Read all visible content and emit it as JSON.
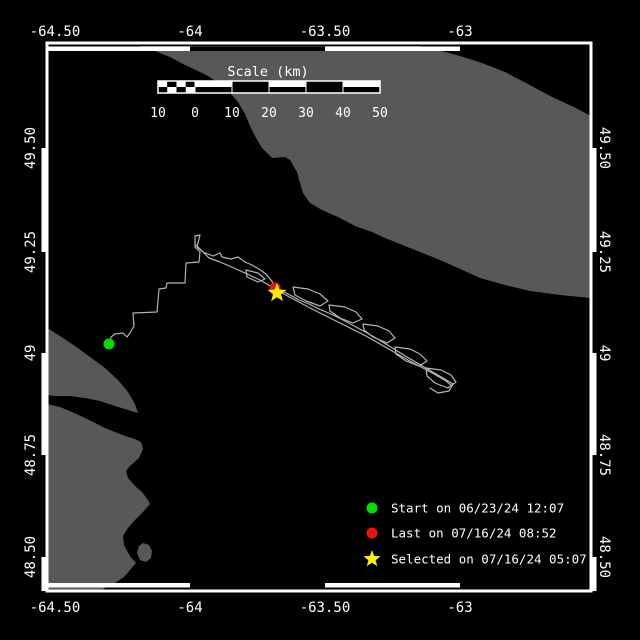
{
  "colors": {
    "background": "#000000",
    "land": "#585858",
    "frame": "#ffffff",
    "track": "#b4b4b4",
    "text": "#ffffff",
    "start": "#00dd00",
    "last": "#ee1111",
    "selected": "#ffee00"
  },
  "frame": {
    "left": 47,
    "top": 43,
    "right": 591,
    "bottom": 591
  },
  "axes": {
    "top_labels": [
      {
        "text": "-64.50",
        "x": 55
      },
      {
        "text": "-64",
        "x": 190
      },
      {
        "text": "-63.50",
        "x": 325
      },
      {
        "text": "-63",
        "x": 460
      }
    ],
    "bottom_labels": [
      {
        "text": "-64.50",
        "x": 55
      },
      {
        "text": "-64",
        "x": 190
      },
      {
        "text": "-63.50",
        "x": 325
      },
      {
        "text": "-63",
        "x": 460
      }
    ],
    "left_labels": [
      {
        "text": "49.50",
        "y": 148
      },
      {
        "text": "49.25",
        "y": 252
      },
      {
        "text": "49",
        "y": 353
      },
      {
        "text": "48.75",
        "y": 455
      },
      {
        "text": "48.50",
        "y": 557
      }
    ],
    "right_labels": [
      {
        "text": "49.50",
        "y": 148
      },
      {
        "text": "49.25",
        "y": 252
      },
      {
        "text": "49",
        "y": 353
      },
      {
        "text": "48.75",
        "y": 455
      },
      {
        "text": "48.50",
        "y": 557
      }
    ]
  },
  "zebra": {
    "lon_boundaries": [
      47,
      190,
      325,
      460,
      591
    ],
    "lat_boundaries": [
      43,
      148,
      252,
      353,
      455,
      557,
      591
    ]
  },
  "scalebar": {
    "title": "Scale (km)",
    "labels": [
      "10",
      "0",
      "10",
      "20",
      "30",
      "40",
      "50"
    ],
    "x_boundaries": [
      158,
      195,
      232,
      269,
      306,
      343,
      380
    ],
    "bar_top": 81,
    "bar_height": 12,
    "label_y": 117,
    "title_x": 268,
    "title_y": 76
  },
  "legend": {
    "x_marker": 372,
    "x_text": 391,
    "rows": [
      {
        "type": "circle",
        "color": "#00dd00",
        "y": 508,
        "label": "Start on 06/23/24 12:07"
      },
      {
        "type": "circle",
        "color": "#ee1111",
        "y": 533,
        "label": "Last on 07/16/24 08:52"
      },
      {
        "type": "star",
        "color": "#ffee00",
        "y": 559,
        "label": "Selected on 07/16/24 05:07"
      }
    ]
  },
  "markers": {
    "start": {
      "shape": "circle",
      "x": 109,
      "y": 344,
      "r": 5.5,
      "color": "#00dd00"
    },
    "last": {
      "shape": "circle",
      "x": 275,
      "y": 288,
      "r": 5.5,
      "color": "#ee1111"
    },
    "selected": {
      "shape": "star",
      "x": 277,
      "y": 293,
      "R": 10,
      "r": 4.2,
      "color": "#ffee00"
    }
  },
  "track": {
    "strands": [
      [
        [
          109,
          344
        ],
        [
          111,
          337
        ],
        [
          115,
          334
        ],
        [
          123,
          333
        ],
        [
          127,
          337
        ],
        [
          130,
          333
        ],
        [
          134,
          326
        ],
        [
          133,
          313
        ],
        [
          157,
          312
        ],
        [
          159,
          289
        ],
        [
          166,
          288
        ],
        [
          167,
          283
        ],
        [
          185,
          283
        ],
        [
          186,
          263
        ],
        [
          199,
          262
        ],
        [
          200,
          252
        ],
        [
          195,
          247
        ],
        [
          195,
          236
        ],
        [
          200,
          235
        ],
        [
          197,
          247
        ],
        [
          203,
          252
        ],
        [
          213,
          256
        ],
        [
          220,
          253
        ],
        [
          222,
          257
        ],
        [
          231,
          259
        ],
        [
          238,
          257
        ],
        [
          245,
          262
        ],
        [
          252,
          265
        ],
        [
          259,
          269
        ],
        [
          266,
          274
        ],
        [
          271,
          280
        ],
        [
          275,
          286
        ]
      ],
      [
        [
          275,
          286
        ],
        [
          282,
          291
        ],
        [
          290,
          295
        ],
        [
          299,
          300
        ],
        [
          309,
          304
        ],
        [
          319,
          309
        ],
        [
          331,
          314
        ],
        [
          343,
          320
        ],
        [
          356,
          327
        ],
        [
          369,
          334
        ],
        [
          381,
          341
        ],
        [
          394,
          349
        ],
        [
          407,
          357
        ],
        [
          419,
          364
        ],
        [
          431,
          371
        ],
        [
          443,
          378
        ],
        [
          453,
          384
        ],
        [
          449,
          391
        ],
        [
          438,
          393
        ],
        [
          430,
          388
        ]
      ],
      [
        [
          196,
          245
        ],
        [
          204,
          253
        ],
        [
          209,
          258
        ],
        [
          220,
          262
        ],
        [
          234,
          268
        ],
        [
          247,
          274
        ],
        [
          260,
          280
        ],
        [
          272,
          287
        ],
        [
          284,
          294
        ],
        [
          297,
          301
        ],
        [
          310,
          308
        ],
        [
          324,
          315
        ],
        [
          338,
          322
        ],
        [
          352,
          329
        ],
        [
          366,
          336
        ],
        [
          380,
          344
        ],
        [
          394,
          352
        ],
        [
          408,
          360
        ],
        [
          421,
          367
        ],
        [
          434,
          374
        ],
        [
          446,
          381
        ],
        [
          452,
          386
        ]
      ],
      [
        [
          246,
          270
        ],
        [
          258,
          273
        ],
        [
          265,
          279
        ],
        [
          258,
          282
        ],
        [
          247,
          277
        ],
        [
          246,
          270
        ]
      ],
      [
        [
          293,
          287
        ],
        [
          308,
          289
        ],
        [
          320,
          294
        ],
        [
          328,
          301
        ],
        [
          320,
          306
        ],
        [
          306,
          301
        ],
        [
          295,
          295
        ],
        [
          293,
          287
        ]
      ],
      [
        [
          329,
          305
        ],
        [
          345,
          307
        ],
        [
          356,
          312
        ],
        [
          362,
          319
        ],
        [
          353,
          323
        ],
        [
          340,
          318
        ],
        [
          330,
          311
        ],
        [
          329,
          305
        ]
      ],
      [
        [
          363,
          324
        ],
        [
          378,
          326
        ],
        [
          389,
          331
        ],
        [
          395,
          338
        ],
        [
          387,
          343
        ],
        [
          373,
          337
        ],
        [
          364,
          330
        ],
        [
          363,
          324
        ]
      ],
      [
        [
          395,
          347
        ],
        [
          410,
          349
        ],
        [
          420,
          354
        ],
        [
          427,
          361
        ],
        [
          419,
          366
        ],
        [
          406,
          361
        ],
        [
          396,
          354
        ],
        [
          395,
          347
        ]
      ],
      [
        [
          426,
          368
        ],
        [
          441,
          370
        ],
        [
          451,
          375
        ],
        [
          456,
          382
        ],
        [
          448,
          388
        ],
        [
          435,
          383
        ],
        [
          427,
          376
        ],
        [
          426,
          368
        ]
      ]
    ]
  },
  "land": {
    "polygons": [
      [
        [
          140,
          46
        ],
        [
          420,
          46
        ],
        [
          438,
          50
        ],
        [
          460,
          56
        ],
        [
          482,
          63
        ],
        [
          505,
          72
        ],
        [
          528,
          84
        ],
        [
          552,
          97
        ],
        [
          574,
          107
        ],
        [
          591,
          116
        ],
        [
          591,
          298
        ],
        [
          560,
          295
        ],
        [
          530,
          291
        ],
        [
          505,
          285
        ],
        [
          480,
          278
        ],
        [
          458,
          268
        ],
        [
          440,
          260
        ],
        [
          420,
          252
        ],
        [
          400,
          244
        ],
        [
          385,
          238
        ],
        [
          372,
          232
        ],
        [
          355,
          226
        ],
        [
          338,
          217
        ],
        [
          322,
          210
        ],
        [
          310,
          203
        ],
        [
          303,
          193
        ],
        [
          300,
          183
        ],
        [
          297,
          172
        ],
        [
          290,
          160
        ],
        [
          285,
          157
        ],
        [
          272,
          158
        ],
        [
          262,
          148
        ],
        [
          256,
          138
        ],
        [
          250,
          126
        ],
        [
          245,
          114
        ],
        [
          238,
          102
        ],
        [
          230,
          93
        ],
        [
          220,
          84
        ],
        [
          208,
          76
        ],
        [
          196,
          70
        ],
        [
          183,
          64
        ],
        [
          170,
          57
        ],
        [
          155,
          51
        ]
      ],
      [
        [
          47,
          328
        ],
        [
          60,
          336
        ],
        [
          75,
          346
        ],
        [
          90,
          357
        ],
        [
          105,
          368
        ],
        [
          118,
          380
        ],
        [
          128,
          392
        ],
        [
          135,
          404
        ],
        [
          138,
          413
        ],
        [
          128,
          410
        ],
        [
          115,
          406
        ],
        [
          100,
          401
        ],
        [
          85,
          398
        ],
        [
          70,
          396
        ],
        [
          55,
          396
        ],
        [
          47,
          395
        ]
      ],
      [
        [
          47,
          404
        ],
        [
          60,
          407
        ],
        [
          72,
          412
        ],
        [
          85,
          418
        ],
        [
          95,
          423
        ],
        [
          105,
          428
        ],
        [
          115,
          432
        ],
        [
          125,
          436
        ],
        [
          135,
          439
        ],
        [
          141,
          442
        ],
        [
          143,
          449
        ],
        [
          139,
          458
        ],
        [
          130,
          466
        ],
        [
          126,
          471
        ],
        [
          128,
          478
        ],
        [
          135,
          486
        ],
        [
          142,
          492
        ],
        [
          148,
          500
        ],
        [
          150,
          504
        ],
        [
          143,
          512
        ],
        [
          135,
          520
        ],
        [
          128,
          528
        ],
        [
          123,
          536
        ],
        [
          124,
          545
        ],
        [
          130,
          556
        ],
        [
          136,
          563
        ],
        [
          130,
          570
        ],
        [
          124,
          577
        ],
        [
          115,
          583
        ],
        [
          105,
          588
        ],
        [
          100,
          591
        ],
        [
          47,
          591
        ]
      ],
      [
        [
          143,
          543
        ],
        [
          149,
          545
        ],
        [
          152,
          551
        ],
        [
          151,
          558
        ],
        [
          146,
          562
        ],
        [
          140,
          560
        ],
        [
          137,
          553
        ],
        [
          139,
          546
        ]
      ]
    ]
  }
}
